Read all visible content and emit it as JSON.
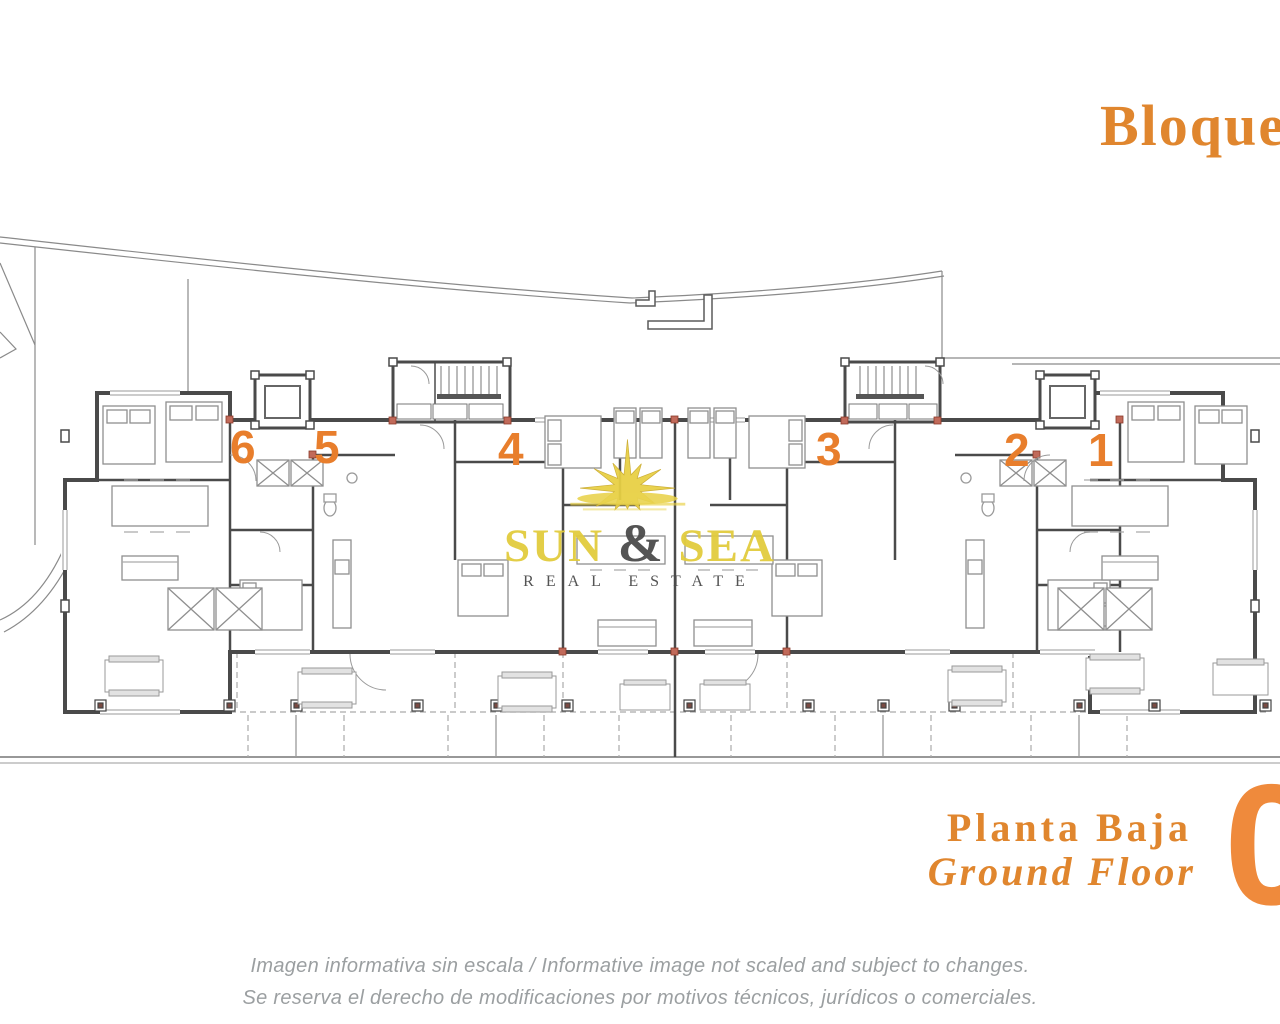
{
  "header": {
    "block_title": "Bloque"
  },
  "plan": {
    "name": "ground-floor-plan",
    "unit_labels": [
      "6",
      "5",
      "4",
      "3",
      "2",
      "1"
    ]
  },
  "watermark": {
    "word1": "SUN",
    "ampersand": "&",
    "word2": "SEA",
    "subtitle": "REAL ESTATE"
  },
  "floor_label": {
    "title_es": "Planta Baja",
    "title_en": "Ground Floor",
    "floor_number": "0"
  },
  "disclaimer": {
    "line1": "Imagen informativa sin escala /  Informative image not scaled and subject to changes.",
    "line2": "Se reserva el derecho de modificaciones por motivos técnicos, jurídicos o comerciales."
  },
  "colors": {
    "accent_orange": "#E0862E",
    "unit_number_orange": "#E87E2C",
    "floor_circle_orange": "#EF8A3C",
    "watermark_yellow": "#E2CB3C",
    "ampersand_gray": "#4A4A4A",
    "disclaimer_gray": "#9B9FA1",
    "wall_gray": "#4A4A4A"
  }
}
